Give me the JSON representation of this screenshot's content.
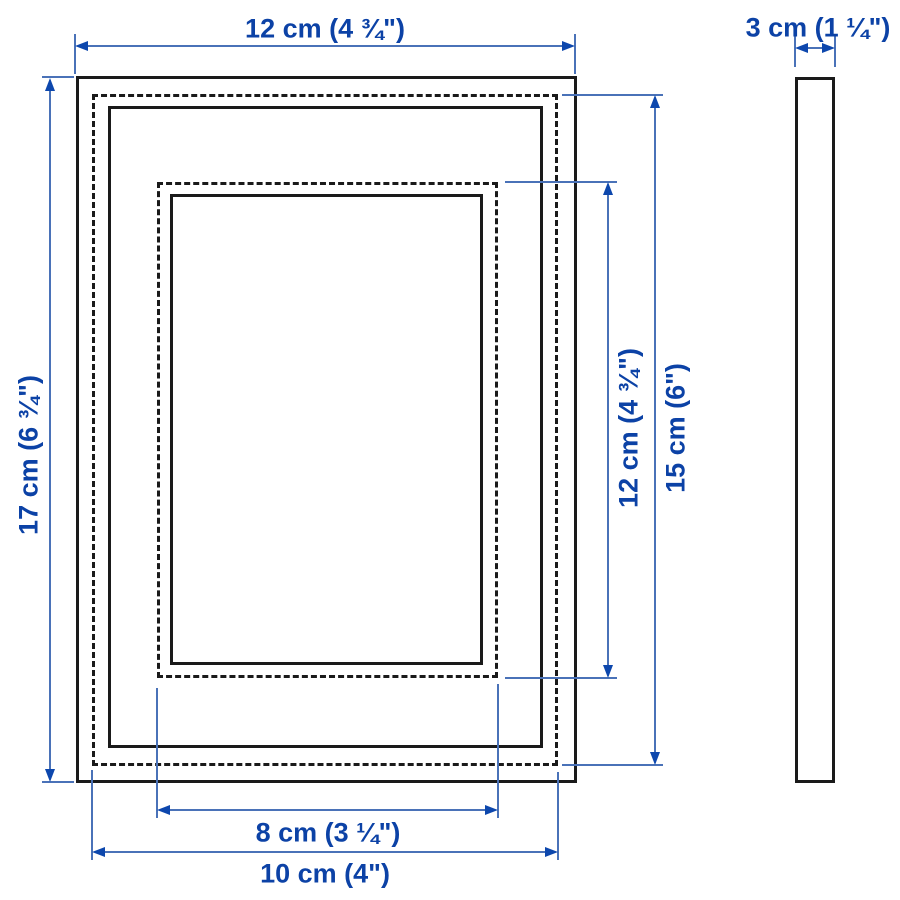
{
  "product": "picture frame dimension diagram",
  "colors": {
    "background": "#ffffff",
    "outline": "#1a1a1a",
    "dimension_line": "#4a72b8",
    "arrow": "#0d47ad",
    "dimension_text": "#0c42a6"
  },
  "dimensions": {
    "frame_width": "12 cm (4 ¾\")",
    "frame_height": "17 cm (6 ¾\")",
    "frame_depth": "3 cm (1 ¼\")",
    "opening_height": "12 cm (4 ¾\")",
    "picture_height": "15 cm (6\")",
    "opening_width": "8 cm (3 ¼\")",
    "picture_width": "10 cm (4\")"
  }
}
